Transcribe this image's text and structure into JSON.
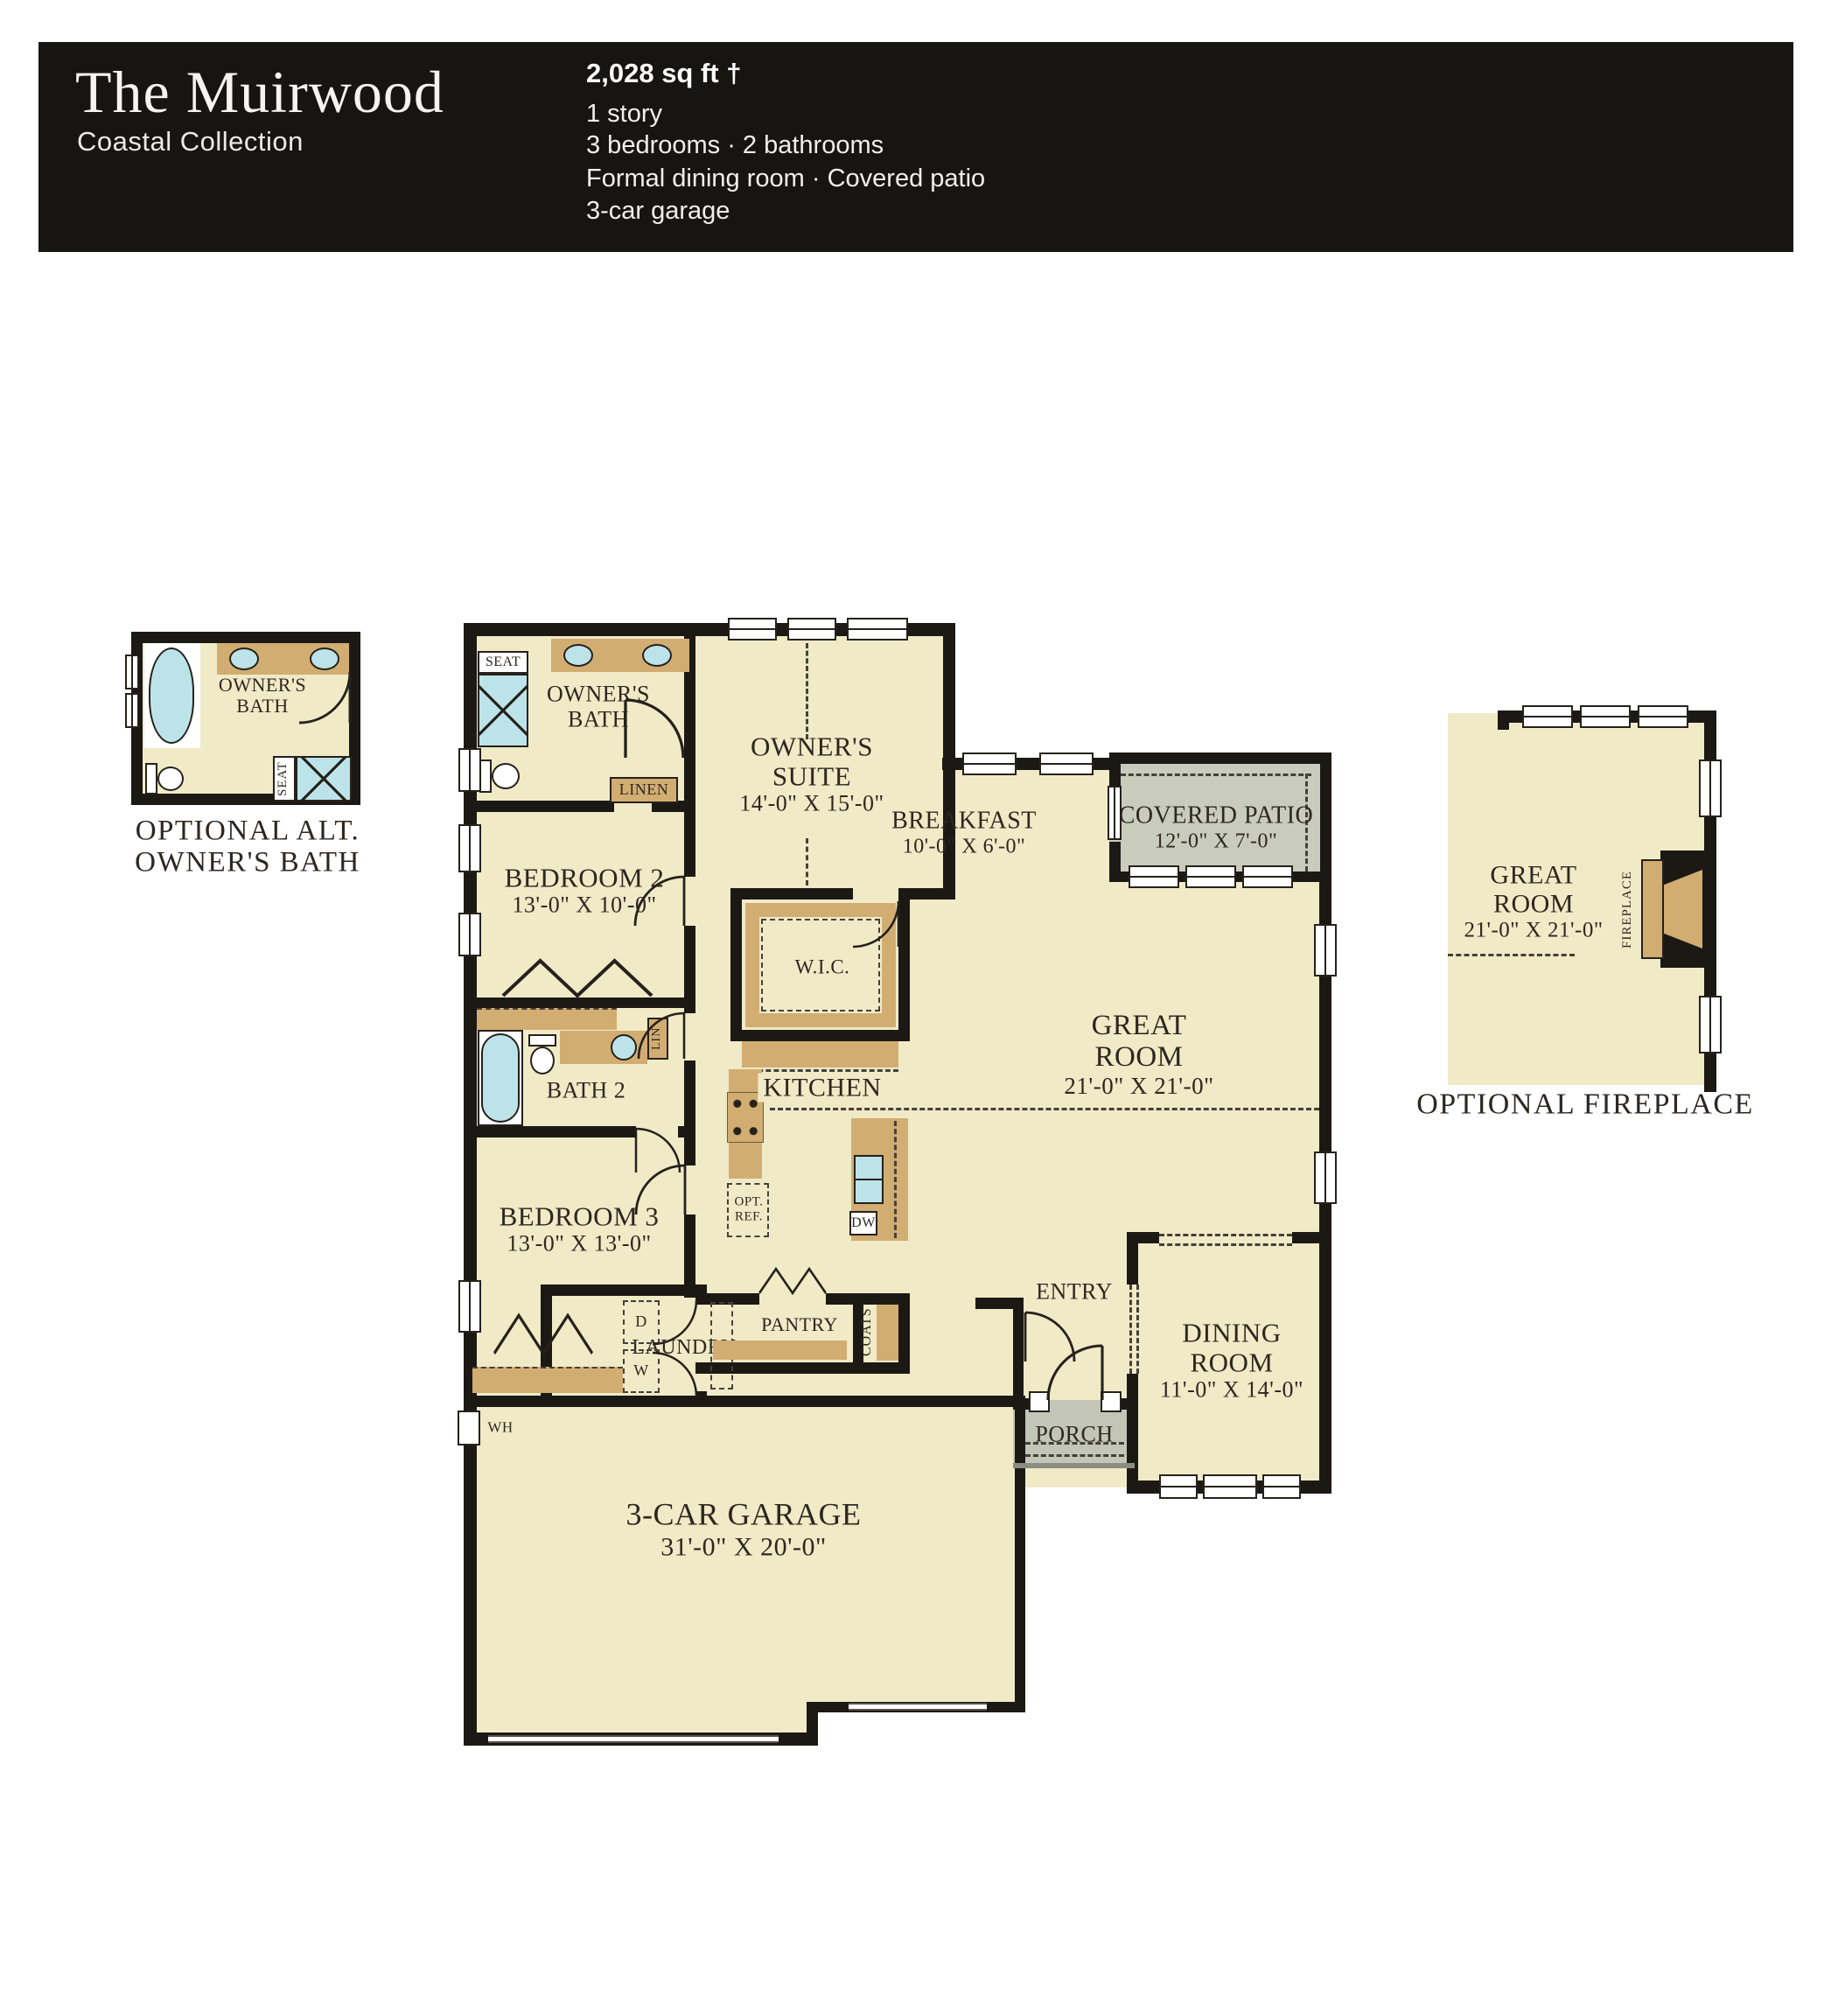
{
  "header": {
    "title": "The Muirwood",
    "subtitle": "Coastal Collection",
    "sqft": "2,028 sq ft †",
    "specs": [
      "1 story",
      "3 bedrooms · 2 bathrooms",
      "Formal dining room · Covered patio",
      "3-car garage"
    ]
  },
  "inset_bath": {
    "room_l1": "OWNER'S",
    "room_l2": "BATH",
    "seat": "SEAT",
    "caption1": "OPTIONAL ALT.",
    "caption2": "OWNER'S BATH"
  },
  "main_plan": {
    "seat": "SEAT",
    "owners_bath_l1": "OWNER'S",
    "owners_bath_l2": "BATH",
    "linen": "LINEN",
    "owners_suite_l1": "OWNER'S",
    "owners_suite_l2": "SUITE",
    "owners_suite_dims": "14'-0\" X 15'-0\"",
    "bedroom2": "BEDROOM 2",
    "bedroom2_dims": "13'-0\" X 10'-0\"",
    "bath2": "BATH 2",
    "lin": "LIN",
    "bedroom3": "BEDROOM 3",
    "bedroom3_dims": "13'-0\" X 13'-0\"",
    "wic": "W.I.C.",
    "kitchen": "KITCHEN",
    "opt_ref_l1": "OPT.",
    "opt_ref_l2": "REF.",
    "dw": "DW",
    "breakfast": "BREAKFAST",
    "breakfast_dims": "10'-0\" X 6'-0\"",
    "covered_patio": "COVERED PATIO",
    "covered_patio_dims": "12'-0\" X 7'-0\"",
    "great_room_l1": "GREAT",
    "great_room_l2": "ROOM",
    "great_room_dims": "21'-0\" X 21'-0\"",
    "entry": "ENTRY",
    "dining_l1": "DINING",
    "dining_l2": "ROOM",
    "dining_dims": "11'-0\" X 14'-0\"",
    "porch": "PORCH",
    "laundry": "LAUNDRY",
    "d": "D",
    "w": "W",
    "pantry": "PANTRY",
    "coats": "COATS",
    "wh": "WH",
    "garage": "3-CAR GARAGE",
    "garage_dims": "31'-0\" X 20'-0\""
  },
  "inset_fireplace": {
    "room_l1": "GREAT",
    "room_l2": "ROOM",
    "room_dims": "21'-0\" X 21'-0\"",
    "fireplace": "FIREPLACE",
    "caption": "OPTIONAL FIREPLACE"
  }
}
